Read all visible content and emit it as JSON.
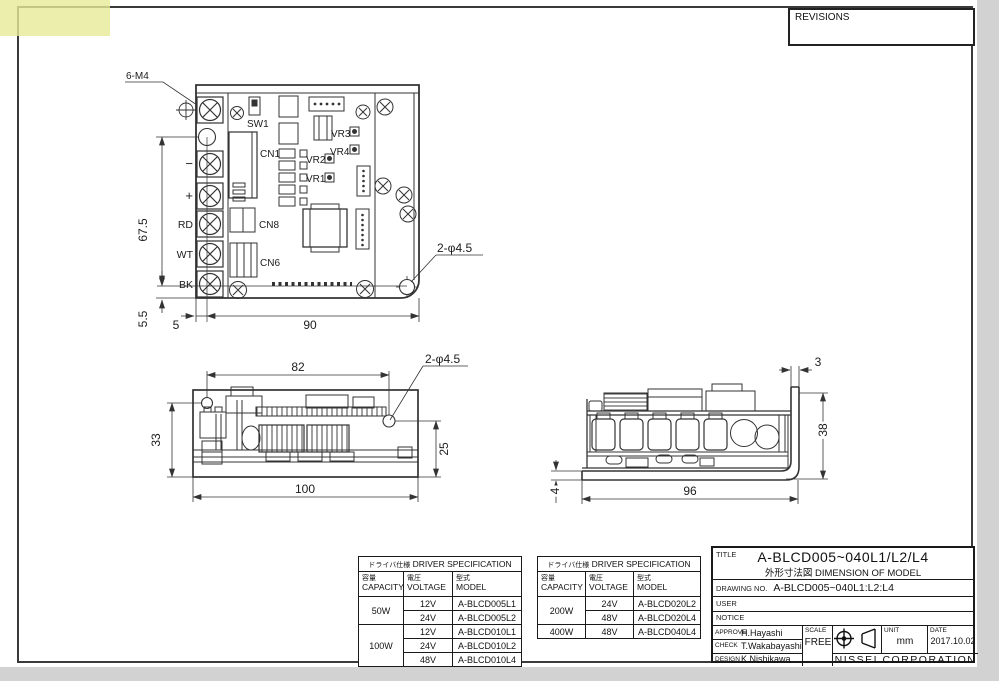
{
  "colors": {
    "line": "#333333",
    "paper": "#ffffff",
    "canvas": "#d2d2d2",
    "highlight": "rgba(230,235,150,0.8)"
  },
  "revisions": {
    "label": "REVISIONS"
  },
  "top_view": {
    "thread_callout": "6-M4",
    "hole_callout": "2-φ4.5",
    "dims": {
      "height": "67.5",
      "bottom_offset": "5.5",
      "left_offset": "5",
      "width": "90"
    },
    "refs": {
      "sw1": "SW1",
      "cn1": "CN1",
      "vr1": "VR1",
      "vr2": "VR2",
      "vr3": "VR3",
      "vr4": "VR4",
      "cn8": "CN8",
      "cn6": "CN6"
    },
    "terminals": [
      "−",
      "+",
      "RD",
      "WT",
      "BK"
    ]
  },
  "front_view": {
    "hole_callout": "2-φ4.5",
    "dims": {
      "hole_span": "82",
      "height": "33",
      "right_height": "25",
      "width": "100"
    }
  },
  "side_view": {
    "dims": {
      "flange_thickness": "3",
      "height": "38",
      "plate_thickness": "4",
      "width": "96"
    }
  },
  "spec_left": {
    "title_jp": "ドライバ仕様",
    "title_en": "DRIVER SPECIFICATION",
    "headers": [
      {
        "jp": "容量",
        "en": "CAPACITY"
      },
      {
        "jp": "電圧",
        "en": "VOLTAGE"
      },
      {
        "jp": "型式",
        "en": "MODEL"
      }
    ],
    "groups": [
      {
        "capacity": "50W",
        "rows": [
          {
            "voltage": "12V",
            "model": "A-BLCD005L1"
          },
          {
            "voltage": "24V",
            "model": "A-BLCD005L2"
          }
        ]
      },
      {
        "capacity": "100W",
        "rows": [
          {
            "voltage": "12V",
            "model": "A-BLCD010L1"
          },
          {
            "voltage": "24V",
            "model": "A-BLCD010L2"
          },
          {
            "voltage": "48V",
            "model": "A-BLCD010L4"
          }
        ]
      }
    ]
  },
  "spec_right": {
    "title_jp": "ドライバ仕様",
    "title_en": "DRIVER SPECIFICATION",
    "headers": [
      {
        "jp": "容量",
        "en": "CAPACITY"
      },
      {
        "jp": "電圧",
        "en": "VOLTAGE"
      },
      {
        "jp": "型式",
        "en": "MODEL"
      }
    ],
    "groups": [
      {
        "capacity": "200W",
        "rows": [
          {
            "voltage": "24V",
            "model": "A-BLCD020L2"
          },
          {
            "voltage": "48V",
            "model": "A-BLCD020L4"
          }
        ]
      },
      {
        "capacity": "400W",
        "rows": [
          {
            "voltage": "48V",
            "model": "A-BLCD040L4"
          }
        ]
      }
    ]
  },
  "title_block": {
    "title_label": "TITLE",
    "title_model": "A-BLCD005~040L1/L2/L4",
    "title_desc": "外形寸法図 DIMENSION OF MODEL",
    "drawing_no_label": "DRAWING NO.",
    "drawing_no": "A-BLCD005~040L1:L2:L4",
    "user_label": "USER",
    "notice_label": "NOTICE",
    "approve_label": "APPROVE",
    "approve_name": "H.Hayashi",
    "check_label": "CHECK",
    "check_name": "T.Wakabayashi",
    "design_label": "DESIGN",
    "design_name": "K.Nishikawa",
    "scale_label": "SCALE",
    "scale_value": "FREE",
    "unit_label": "UNIT",
    "unit_value": "mm",
    "date_label": "DATE",
    "date_value": "2017.10.02",
    "company": "NISSEI CORPORATION"
  }
}
